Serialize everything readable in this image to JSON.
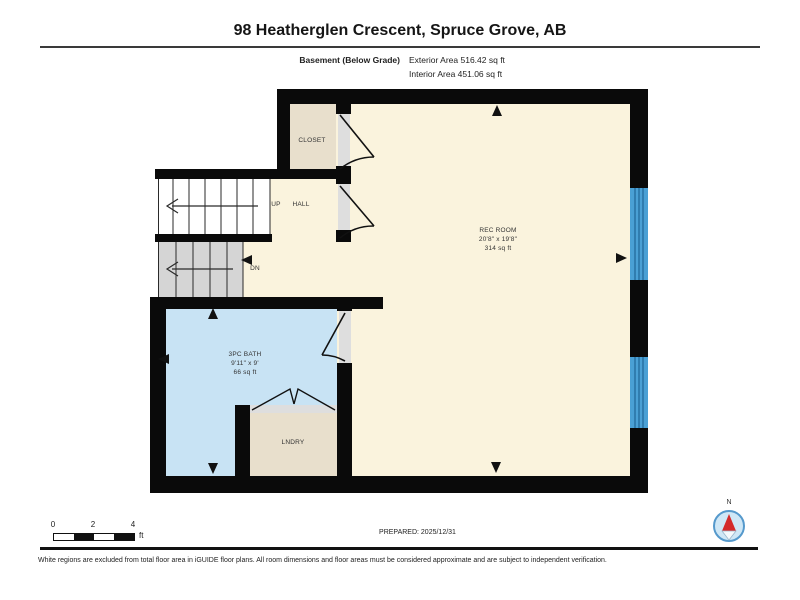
{
  "header": {
    "title": "98 Heatherglen Crescent, Spruce Grove, AB",
    "floor_label": "Basement (Below Grade)",
    "exterior_area": "Exterior Area 516.42 sq ft",
    "interior_area": "Interior Area 451.06 sq ft"
  },
  "rooms": {
    "rec_room": {
      "name": "REC ROOM",
      "dims": "20'8\" x 19'8\"",
      "area": "314 sq ft"
    },
    "bath": {
      "name": "3PC BATH",
      "dims": "9'11\" x 9'",
      "area": "66 sq ft"
    },
    "laundry": {
      "name": "LNDRY"
    },
    "closet": {
      "name": "CLOSET"
    },
    "hall": {
      "name": "HALL"
    }
  },
  "stairs": {
    "up_label": "UP",
    "down_label": "DN"
  },
  "scale_bar": {
    "labels": [
      "0",
      "2",
      "4"
    ],
    "unit": "ft"
  },
  "compass": {
    "north_label": "N"
  },
  "footer": {
    "prepared": "PREPARED: 2025/12/31",
    "disclaimer": "White regions are excluded from total floor area in iGUIDE floor plans. All room dimensions and floor areas must be considered approximate and are subject to independent verification."
  },
  "colors": {
    "wall": "#0a0a0a",
    "interior_floor": "#faf3dd",
    "closet_floor": "#e8dfcc",
    "bath_floor": "#c8e3f4",
    "stair_down_floor": "#d5d5d5",
    "window_blue": "#4aa0d5",
    "compass_ring": "#5599cc",
    "compass_needle_red": "#d42a2a"
  }
}
